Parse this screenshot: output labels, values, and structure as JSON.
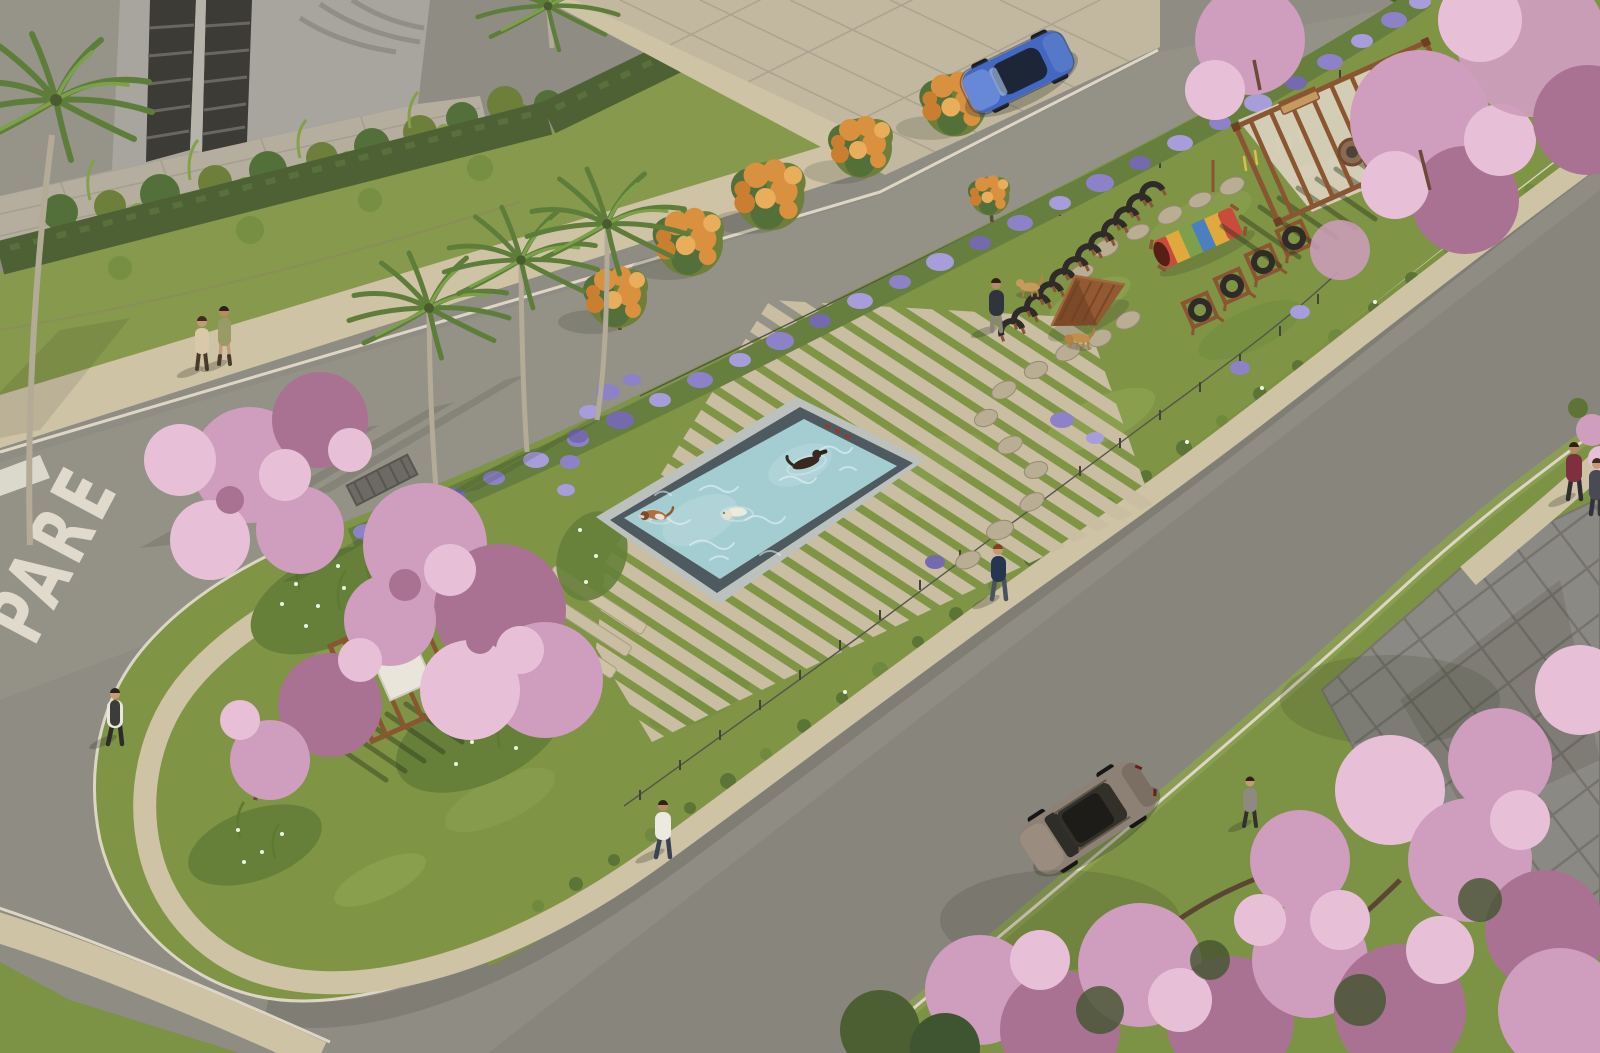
{
  "meta": {
    "description": "Aerial architectural rendering of a linear boulevard dog park with pool, agility course, pergolas and flowering trees",
    "image_type": "architectural-render"
  },
  "road": {
    "stop_marking_text": "PARE"
  },
  "colors": {
    "asphalt": "#8f8c83",
    "asphalt_dark": "#7f7c73",
    "island_lawn": "#7f9445",
    "sidewalk": "#cfc3a6",
    "curb": "#ddd6c4",
    "hedge": "#4d6134",
    "building_wall": "#a7a59d",
    "building_shade": "#969489",
    "window": "#3c3b36",
    "purple_flowers": "#8d82c8",
    "pink_blossom": "#cf9dbd",
    "pink_blossom_light": "#e7c0d8",
    "orange_flowers": "#d9913f",
    "white_flowers": "#eef2e2",
    "pool_water": "#a4cdd2",
    "pool_wall": "#4e5a60",
    "pool_coping": "#bcc1bd",
    "deck_stone": "#c9bda2",
    "stepping_stone": "#b9ae93",
    "wood": "#8a5531",
    "plaza": "#8b8983",
    "fence": "#44443c",
    "tire_black": "#2e2b28",
    "tunnel_red": "#c84b3c",
    "tunnel_yellow": "#e0a93e",
    "tunnel_green": "#7fa04a",
    "tunnel_blue": "#4a7fc0",
    "car_blue": "#4468c2",
    "car_bronze": "#8d8074",
    "skin": "#c59a76"
  },
  "scene": {
    "counts": {
      "people": 9,
      "dogs": 5,
      "cars": 2,
      "pergolas": 2,
      "palm_trees": 5
    },
    "landmarks": [
      "dog-pool",
      "deck-strips",
      "agility-course",
      "tire-hoop-run",
      "a-frame-ramp",
      "rainbow-tunnel",
      "tire-jumps",
      "stepping-stones",
      "pergola-northeast",
      "pergola-west",
      "fire-pit",
      "bench",
      "stop-marking",
      "plaza-southeast",
      "apartment-building",
      "flowering-trees"
    ]
  }
}
